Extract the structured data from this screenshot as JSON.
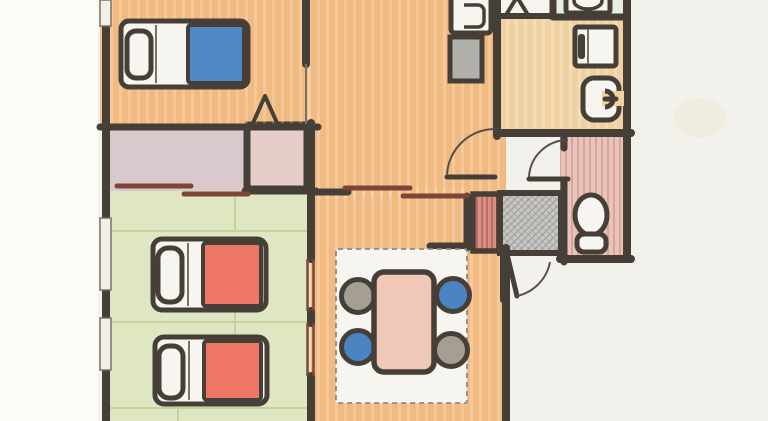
{
  "document": {
    "type": "floor-plan-sketch",
    "style": "hand-drawn colored-pencil apartment floor plan, scanned, cropped at top and bottom edges",
    "text_labels": []
  },
  "colors": {
    "paper": "#f3f1ec",
    "paper_margin": "#fbfbf8",
    "stain": "#e8ddb4",
    "wall": "#463f38",
    "wall_light": "#7a7268",
    "door_arc": "#56504a",
    "floor_orange": "#f1ba81",
    "floor_tan": "#f0d2a2",
    "floor_green": "#dfe7c2",
    "tatami_line": "#c6d29e",
    "closet_mauve": "#d9c9cc",
    "closet_pink": "#e6cdc9",
    "toilet_pink": "#eac4bb",
    "laundry_mint": "#e6efe6",
    "shower_white": "#f6f4ef",
    "genkan_gray": "#c7c6c3",
    "fixture_white": "#f7f5f0",
    "appliance_gray": "#b2b0ab",
    "blanket_blue": "#4f88c5",
    "blanket_red": "#ee7767",
    "table_pink": "#f0c8b8",
    "chair_blue": "#4a84c2",
    "chair_gray": "#a49f92",
    "slider_red": "#7d4538",
    "shoe_cabinet": "#d98e86",
    "window_fill": "#f1efe9"
  },
  "rooms": [
    {
      "name": "bedroom",
      "floor_color": "floor_orange",
      "contents": [
        "single bed with blue blanket",
        "triangle marker near closet"
      ]
    },
    {
      "name": "closet-wide",
      "floor_color": "closet_mauve",
      "contents": [
        "two offset sliding-door rails"
      ]
    },
    {
      "name": "closet-sub",
      "floor_color": "closet_pink",
      "contents": []
    },
    {
      "name": "tatami-room",
      "floor_color": "floor_green",
      "contents": [
        "two single beds with red blankets",
        "two fusuma sliding panels on east wall",
        "two windows on west wall"
      ]
    },
    {
      "name": "hall",
      "floor_color": "floor_orange",
      "contents": [
        "kitchen sink unit",
        "gray washing machine",
        "swing door to bathroom corridor"
      ]
    },
    {
      "name": "dining-room",
      "floor_color": "floor_orange",
      "contents": [
        "area rug",
        "dining table",
        "four round chairs"
      ]
    },
    {
      "name": "bathroom",
      "floor_color": "floor_tan",
      "contents": [
        "vanity basin",
        "bathtub"
      ]
    },
    {
      "name": "shower-nook",
      "floor_color": "shower_white",
      "contents": [
        "triangle marker"
      ]
    },
    {
      "name": "laundry-nook",
      "floor_color": "laundry_mint",
      "contents": [
        "laundry pan"
      ]
    },
    {
      "name": "toilet-room",
      "floor_color": "toilet_pink",
      "contents": [
        "toilet with tank",
        "swing door"
      ]
    },
    {
      "name": "genkan-entry",
      "floor_color": "genkan_gray",
      "contents": [
        "hatched entry step",
        "shoe cabinet",
        "entrance swing door"
      ]
    }
  ],
  "furniture": [
    {
      "name": "single-bed",
      "room": "bedroom",
      "blanket_color": "blanket_blue",
      "pillow_side": "left"
    },
    {
      "name": "single-bed",
      "room": "tatami-room",
      "blanket_color": "blanket_red",
      "pillow_side": "left"
    },
    {
      "name": "single-bed",
      "room": "tatami-room",
      "blanket_color": "blanket_red",
      "pillow_side": "left"
    },
    {
      "name": "dining-table",
      "room": "dining-room",
      "color": "table_pink"
    },
    {
      "name": "chair",
      "room": "dining-room",
      "position": "top-left",
      "color": "chair_gray"
    },
    {
      "name": "chair",
      "room": "dining-room",
      "position": "top-right",
      "color": "chair_blue"
    },
    {
      "name": "chair",
      "room": "dining-room",
      "position": "bottom-left",
      "color": "chair_blue"
    },
    {
      "name": "chair",
      "room": "dining-room",
      "position": "bottom-right",
      "color": "chair_gray"
    },
    {
      "name": "area-rug",
      "room": "dining-room",
      "border": "dashed"
    },
    {
      "name": "kitchen-sink",
      "room": "hall"
    },
    {
      "name": "washing-machine",
      "room": "hall",
      "color": "appliance_gray"
    },
    {
      "name": "bathroom-vanity",
      "room": "bathroom"
    },
    {
      "name": "bathtub",
      "room": "bathroom"
    },
    {
      "name": "laundry-pan",
      "room": "laundry-nook"
    },
    {
      "name": "toilet",
      "room": "toilet-room"
    },
    {
      "name": "shoe-cabinet",
      "room": "genkan-entry",
      "color": "shoe_cabinet"
    }
  ],
  "doors": [
    {
      "name": "closet-sliding-doors",
      "type": "double-slider"
    },
    {
      "name": "hall-dining-sliding-doors",
      "type": "double-slider"
    },
    {
      "name": "tatami-fusuma",
      "type": "double-slider"
    },
    {
      "name": "washroom-swing-door",
      "type": "swing"
    },
    {
      "name": "toilet-swing-door",
      "type": "swing"
    },
    {
      "name": "entrance-swing-door",
      "type": "swing"
    },
    {
      "name": "bedroom-doorway",
      "type": "open"
    }
  ]
}
